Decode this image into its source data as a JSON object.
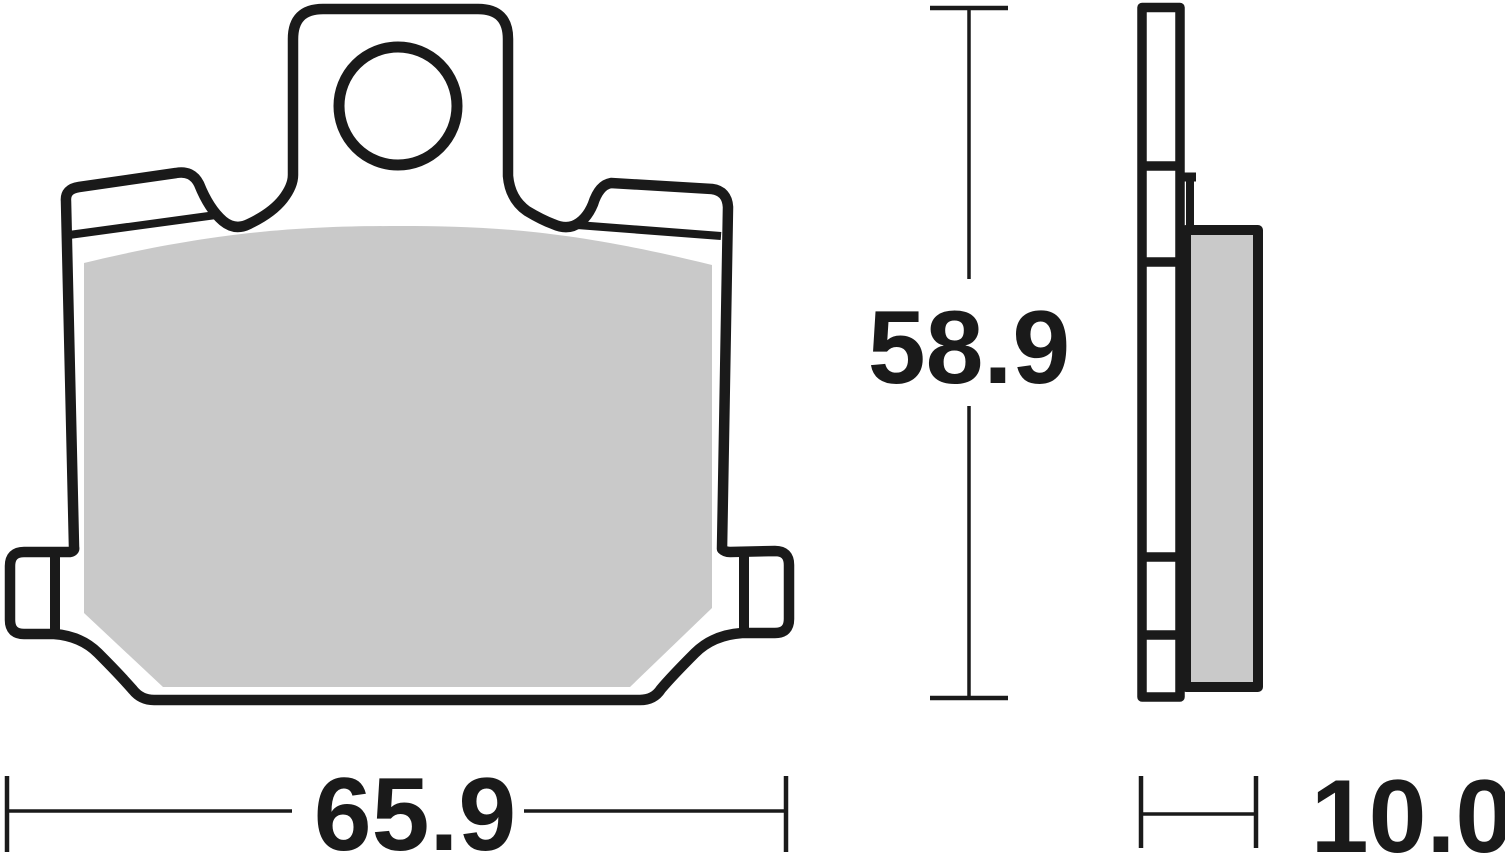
{
  "dimensions": {
    "width": "65.9",
    "height": "58.9",
    "thickness": "10.0"
  },
  "colors": {
    "outline": "#1a1a1a",
    "friction": "#c9c9c9",
    "background": "#ffffff"
  }
}
